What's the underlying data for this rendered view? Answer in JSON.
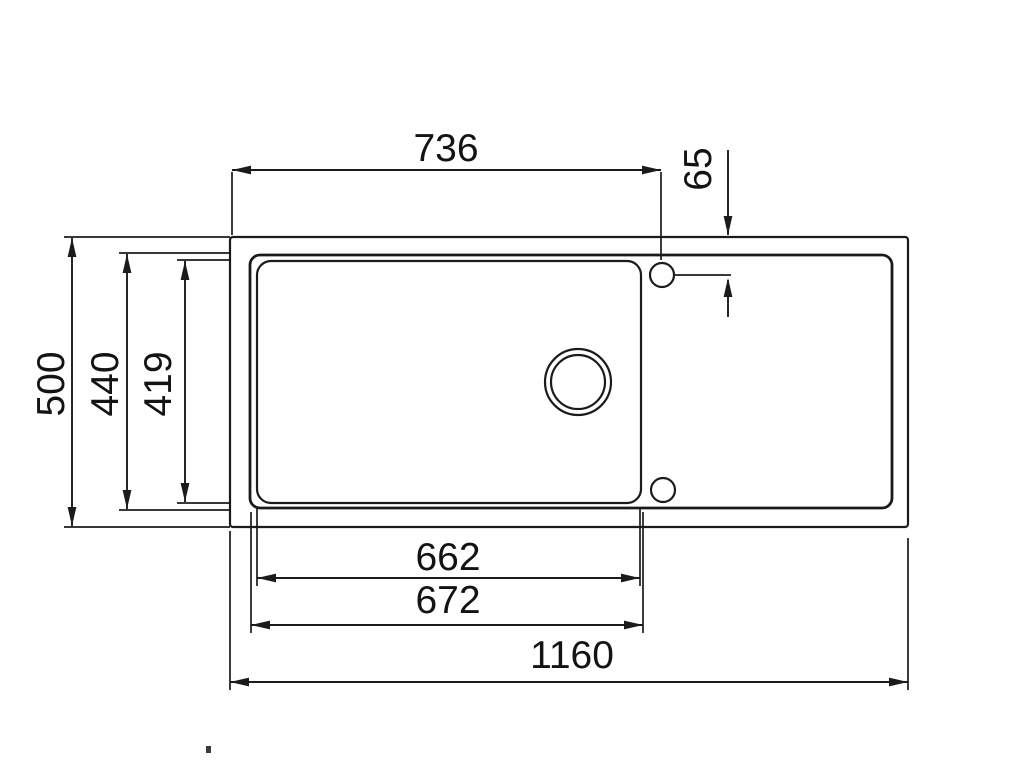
{
  "drawing": {
    "colors": {
      "line": "#1b1b1b",
      "background": "#ffffff"
    },
    "dimensions": {
      "top_width": "736",
      "tap_hole_offset": "65",
      "overall_depth": "500",
      "rim_depth": "440",
      "bowl_depth": "419",
      "bowl_inner_width": "662",
      "bowl_outer_width": "672",
      "overall_width": "1160"
    }
  }
}
